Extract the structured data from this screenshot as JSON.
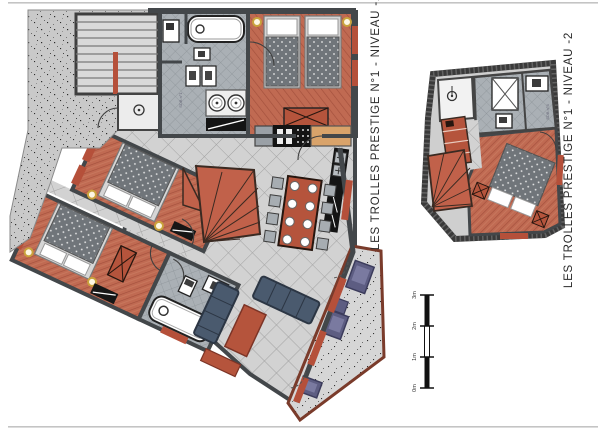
{
  "page": {
    "background": "#ffffff",
    "document_type": "architectural floor plans"
  },
  "plans": [
    {
      "id": "niveau-1",
      "title": "LES TROLLES PRESTIGE N°1 - NIVEAU -1"
    },
    {
      "id": "niveau-2",
      "title": "LES TROLLES PRESTIGE N°1 - NIVEAU -2"
    }
  ],
  "room_labels": {
    "bath1": "SDB n°1",
    "bath4": "SDB n°4"
  },
  "scale_bar": {
    "labels": [
      "3m",
      "2m",
      "1m",
      "0m"
    ]
  },
  "colors": {
    "wall": "#43474a",
    "wood_floor": "#c06a52",
    "wood_line": "#a3503c",
    "tile_light": "#d2d2d2",
    "tile_dark": "#aab0b5",
    "concrete": "#c9c9c9",
    "window_red": "#b5503a",
    "furniture_red": "#b5543c",
    "sofa_blue": "#4a5a6e",
    "outdoor_purple": "#5d5d82",
    "bed_gray": "#70757a",
    "counter_black": "#141414",
    "counter_tan": "#d9a36a"
  }
}
